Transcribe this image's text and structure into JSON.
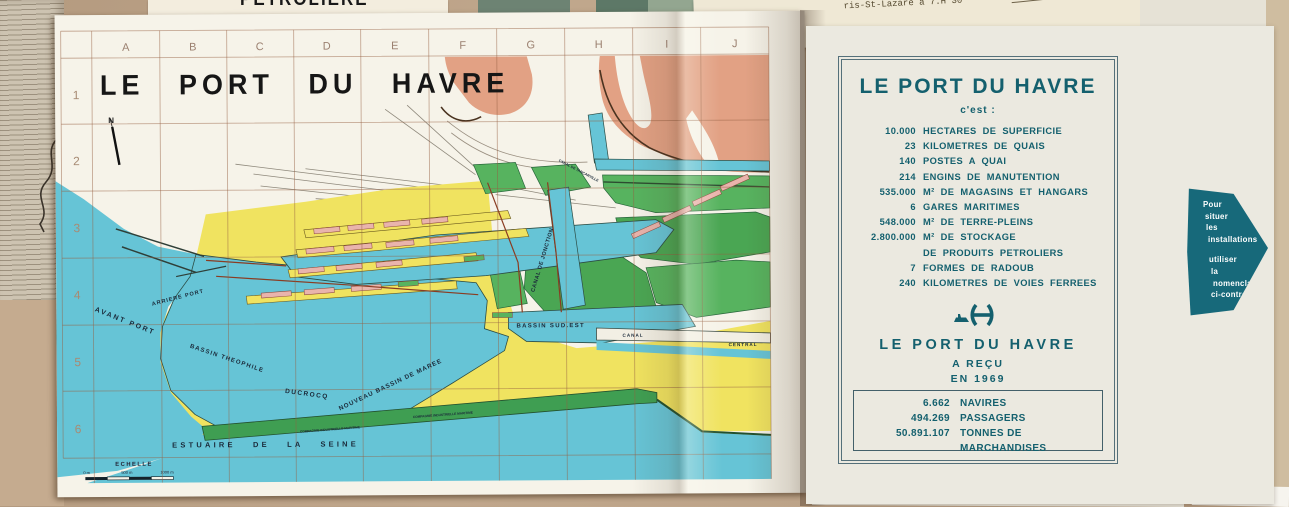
{
  "map": {
    "title": "LE  PORT  DU  HAVRE",
    "grid": {
      "columns": [
        "A",
        "B",
        "C",
        "D",
        "E",
        "F",
        "G",
        "H",
        "I",
        "J"
      ],
      "rows": [
        "1",
        "2",
        "3",
        "4",
        "5",
        "6"
      ]
    },
    "labels": {
      "north": "N",
      "avant_port": "AVANT  PORT",
      "arriere_port": "ARRIERE  PORT",
      "bassin_ducrocq": "BASSIN   THEOPHILE",
      "ducrocq": "DUCROCQ",
      "nouveau_bassin": "NOUVEAU   BASSIN   DE   MAREE",
      "bassin_sud_est": "BASSIN  SUD.EST",
      "canal_jonction": "CANAL DE JONCTION",
      "canal": "CANAL",
      "central": "CENTRAL",
      "canal_tancarville": "CANAL DE TANCARVILLE",
      "estuaire": "ESTUAIRE   DE   LA   SEINE",
      "echelle": "ECHELLE",
      "cim1": "COMPAGNIE  INDUSTRIELLE  MARITIME",
      "cim2": "COMPAGNIE  INDUSTRIELLE  MARITIME",
      "scale_0": "0 m",
      "scale_500": "500 m",
      "scale_1000": "1000 m"
    }
  },
  "panel": {
    "title": "LE PORT DU HAVRE",
    "subtitle": "c'est :",
    "stats": [
      {
        "value": "10.000",
        "label": "HECTARES DE SUPERFICIE"
      },
      {
        "value": "23",
        "label": "KILOMETRES DE QUAIS"
      },
      {
        "value": "140",
        "label": "POSTES A QUAI"
      },
      {
        "value": "214",
        "label": "ENGINS DE MANUTENTION"
      },
      {
        "value": "535.000",
        "label": "M² DE MAGASINS ET HANGARS"
      },
      {
        "value": "6",
        "label": "GARES MARITIMES"
      },
      {
        "value": "548.000",
        "label": "M² DE TERRE-PLEINS"
      },
      {
        "value": "2.800.000",
        "label": "M² DE STOCKAGE"
      },
      {
        "value": "",
        "label": "DE PRODUITS PETROLIERS"
      },
      {
        "value": "7",
        "label": "FORMES DE RADOUB"
      },
      {
        "value": "240",
        "label": "KILOMETRES DE VOIES FERREES"
      }
    ],
    "received": {
      "title": "LE PORT DU HAVRE",
      "line1": "A REÇU",
      "line2": "EN 1969",
      "items": [
        {
          "value": "6.662",
          "label": "NAVIRES"
        },
        {
          "value": "494.269",
          "label": "PASSAGERS"
        },
        {
          "value": "50.891.107",
          "label": "TONNES DE MARCHANDISES"
        }
      ]
    }
  },
  "arrow": {
    "lines": [
      "Pour",
      "situer",
      "les",
      "installations",
      "utiliser",
      "la",
      "nomenclature",
      "ci-contre"
    ]
  },
  "background": {
    "petroliere_fragment": "PETROLIERE",
    "d_fragment": "D",
    "typed_line1": "• Arrivée au",
    "typed_line2": "ris-St-Lazare à 7.H 30",
    "typed_line3": "1970)"
  },
  "colors": {
    "sea": "#66c4d6",
    "land_yellow": "#f0e360",
    "fields_green": "#57b35f",
    "coast_salmon": "#e2a184",
    "hangar_pink": "#e9b4ac",
    "panel_teal": "#14606e",
    "arrow_teal": "#17697a",
    "grid_brown": "#c49a82"
  }
}
